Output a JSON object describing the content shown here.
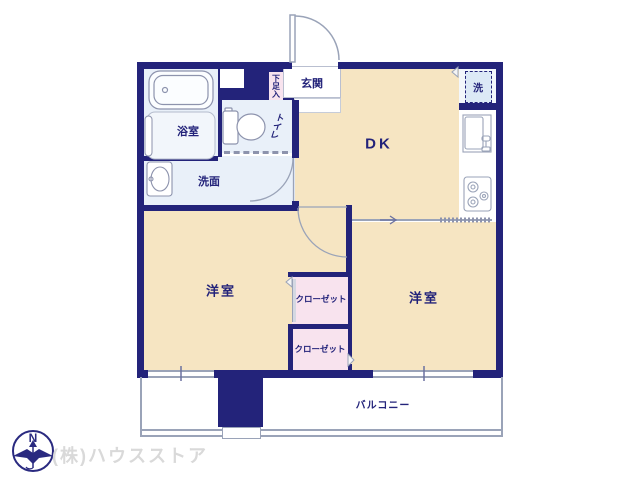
{
  "theme": {
    "wall": "#23237a",
    "room_cream": "#f6e5c2",
    "room_blue": "#e9f0f9",
    "closet_pink": "#f8e3ee",
    "laundry_fill": "#dce9f6",
    "laundry_floor": "#f3f7fc",
    "line_gray": "#9aa3b8",
    "text_navy": "#23237a",
    "watermark": "#d9d9d9"
  },
  "rooms": {
    "entrance": "玄関",
    "shoe_box": "下足入",
    "dk": "DK",
    "bathroom": "浴室",
    "toilet": "トイレ",
    "washroom": "洗面",
    "laundry": "洗",
    "western_room_left": "洋室",
    "western_room_right": "洋室",
    "closet_upper": "クローゼット",
    "closet_lower": "クローゼット",
    "balcony": "バルコニー"
  },
  "compass": {
    "north_label": "N"
  },
  "footer": {
    "company": "(株)ハウスストア"
  }
}
